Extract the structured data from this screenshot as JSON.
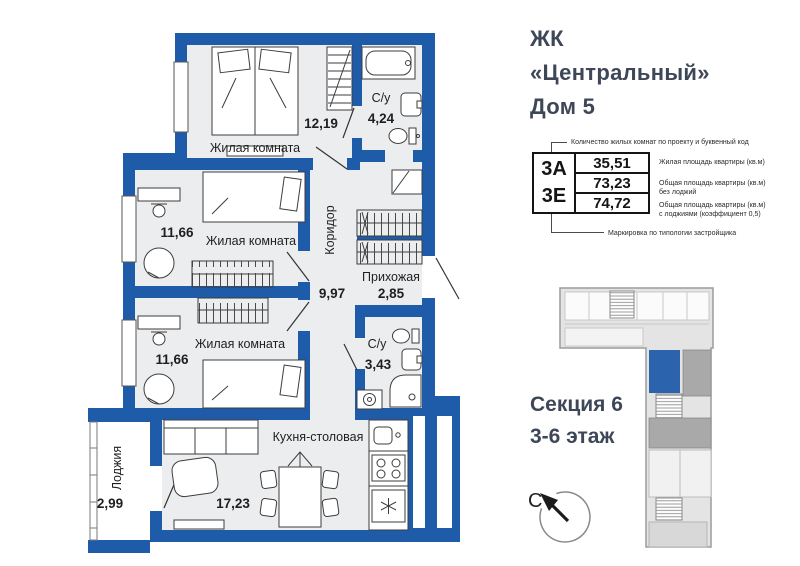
{
  "header": {
    "project": "ЖК",
    "name": "«Центральный»",
    "house": "Дом 5"
  },
  "legend": {
    "top_note": "Количество жилых комнат по проекту и буквенный код",
    "room_code": "3А",
    "type_code": "3Е",
    "living_area": "35,51",
    "area_no_loggia": "73,23",
    "area_with_loggia": "74,72",
    "living_area_note": "Жилая площадь квартиры (кв.м)",
    "area_no_loggia_note_1": "Общая площадь квартиры (кв.м)",
    "area_no_loggia_note_2": "без лоджий",
    "area_with_loggia_note_1": "Общая площадь квартиры (кв.м)",
    "area_with_loggia_note_2": "с лоджиями (коэффициент 0,5)",
    "bottom_note": "Маркировка по типологии застройщика"
  },
  "section_info": {
    "section": "Секция 6",
    "floors": "3-6 этаж"
  },
  "compass": {
    "north": "С"
  },
  "plan": {
    "rooms": [
      {
        "name": "Жилая комната",
        "area": "12,19"
      },
      {
        "name": "С/у",
        "area": "4,24"
      },
      {
        "name": "Жилая комната",
        "area": "11,66"
      },
      {
        "name": "Коридор",
        "area": "9,97"
      },
      {
        "name": "Прихожая",
        "area": "2,85"
      },
      {
        "name": "Жилая комната",
        "area": "11,66"
      },
      {
        "name": "С/у",
        "area": "3,43"
      },
      {
        "name": "Кухня-столовая",
        "area": "17,23"
      },
      {
        "name": "Лоджия",
        "area": "2,99"
      }
    ]
  },
  "colors": {
    "wall": "#1e5caa",
    "floor": "#ecedef",
    "minimap_unit": "#2b63ad",
    "minimap_body": "#e4e4e4",
    "title_text": "#3e4757"
  }
}
